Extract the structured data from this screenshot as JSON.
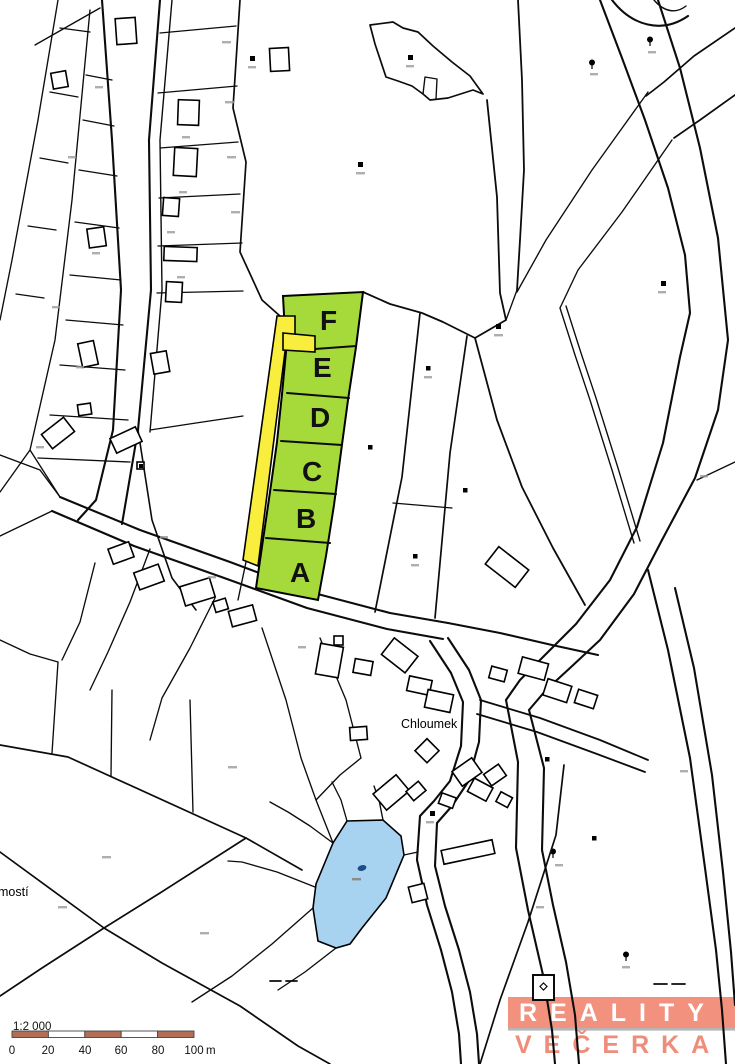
{
  "map": {
    "highlighted_parcels": [
      {
        "label": "A"
      },
      {
        "label": "B"
      },
      {
        "label": "C"
      },
      {
        "label": "D"
      },
      {
        "label": "E"
      },
      {
        "label": "F"
      }
    ],
    "place_labels": {
      "village": "Chloumek",
      "edge_partial": "mostí"
    },
    "colors": {
      "parcel_green": "#a5da3a",
      "access_strip_yellow": "#f9ee3d",
      "water_blue": "#a8d3f0",
      "line": "#0c0c0c"
    }
  },
  "scale_bar": {
    "ratio_label": "1:2 000",
    "tick_labels": [
      "0",
      "20",
      "40",
      "60",
      "80",
      "100"
    ],
    "unit_label": "m",
    "segment_color": "#b36e58"
  },
  "logo": {
    "line1": "REALITY",
    "line2": "VEČERKA",
    "band_color": "#f2917e",
    "text_color": "#ee8d7a"
  }
}
